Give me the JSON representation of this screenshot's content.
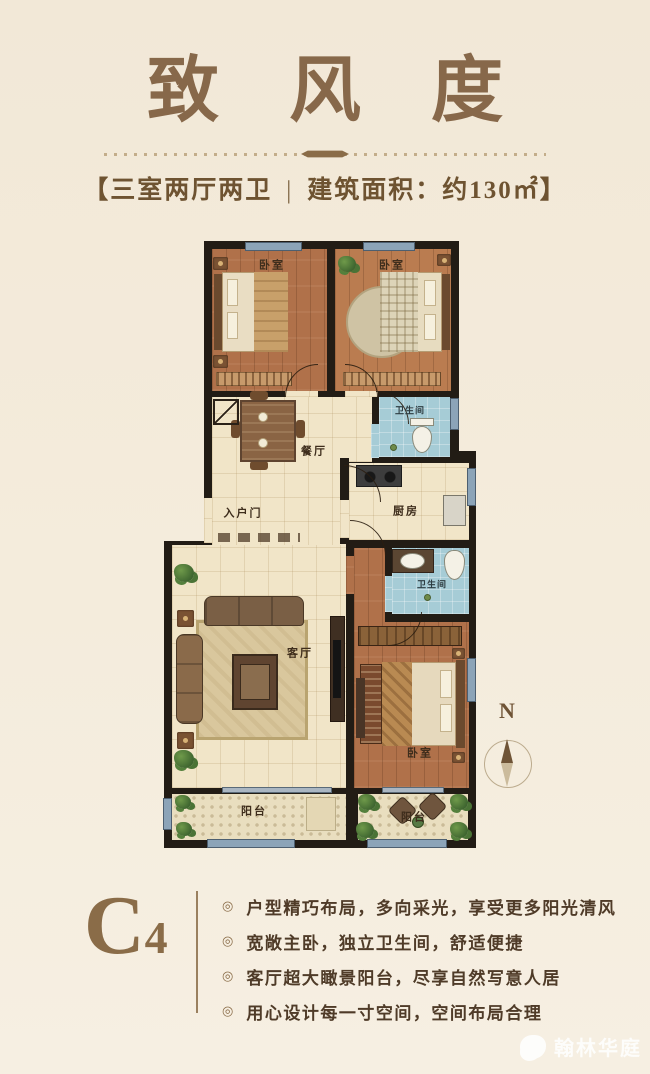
{
  "page": {
    "background": "#f3eadb"
  },
  "header": {
    "title": "致 风 度",
    "subtitle_open": "【",
    "subtitle_left": "三室两厅两卫",
    "subtitle_divider": "|",
    "subtitle_right": "建筑面积：约130㎡",
    "subtitle_close": "】"
  },
  "floorplan": {
    "compass_label": "N",
    "entry_label": "入户门",
    "rooms": [
      {
        "key": "bedroom-top-left",
        "label": "卧室"
      },
      {
        "key": "bedroom-top-right",
        "label": "卧室"
      },
      {
        "key": "bathroom-upper",
        "label": "卫生间"
      },
      {
        "key": "dining-room",
        "label": "餐厅"
      },
      {
        "key": "kitchen",
        "label": "厨房"
      },
      {
        "key": "bathroom-master",
        "label": "卫生间"
      },
      {
        "key": "living-room",
        "label": "客厅"
      },
      {
        "key": "bedroom-master",
        "label": "卧室"
      },
      {
        "key": "balcony-left",
        "label": "阳台"
      },
      {
        "key": "balcony-right",
        "label": "阳台"
      }
    ],
    "colors": {
      "wall": "#221c15",
      "wood_floor": "#b0714a",
      "tile_floor": "#f1e5c8",
      "bath_blue": "#a6ccd6",
      "window": "#8ca4b8",
      "balcony_floor": "#e9debf",
      "plant_green": "#4e7538"
    }
  },
  "unit": {
    "code_main": "C",
    "code_sub": "4",
    "bullet_glyph": "◎",
    "features": [
      "户型精巧布局，多向采光，享受更多阳光清风",
      "宽敞主卧，独立卫生间，舒适便捷",
      "客厅超大瞰景阳台，尽享自然写意人居",
      "用心设计每一寸空间，空间布局合理"
    ]
  },
  "watermark": {
    "text": "翰林华庭"
  },
  "palette": {
    "accent_brown": "#8a6c48",
    "text_brown": "#4f3b28",
    "title_brown": "#87684a"
  }
}
